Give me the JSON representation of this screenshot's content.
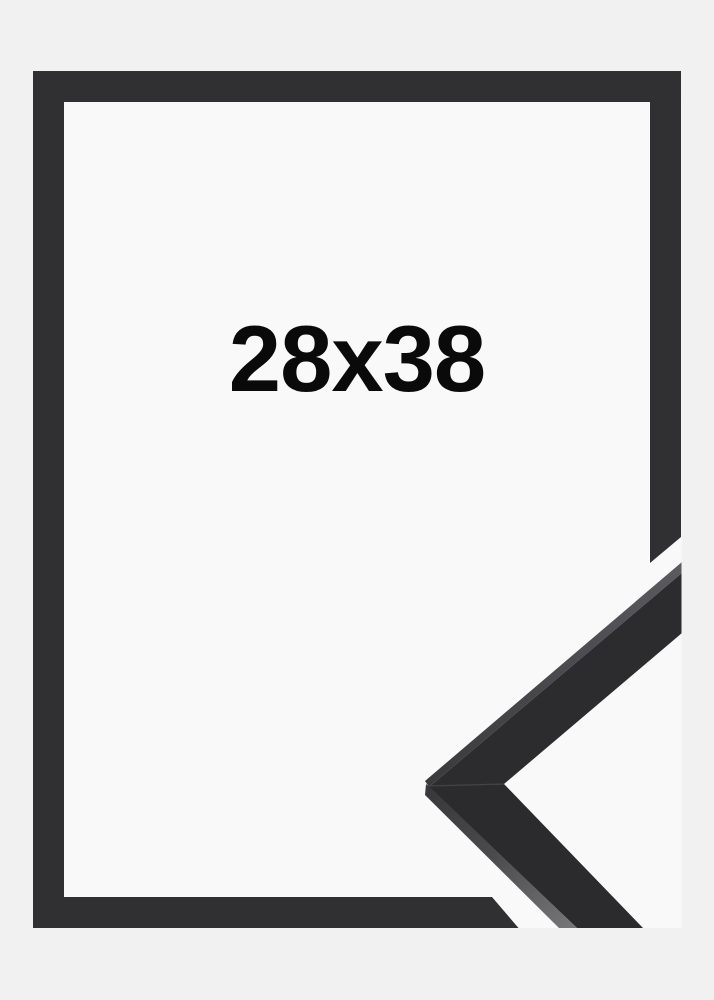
{
  "page": {
    "background_color": "#f1f1f2"
  },
  "product_image": {
    "size_label": "28x38",
    "text_color": "#0a0a0a",
    "backdrop_color": "#f9f9fa",
    "frame_graphic": {
      "border_color": "#303032"
    },
    "corner_sample_photo": {
      "face_color": "#2c2c2e",
      "face_color_lower": "#2b2b2d",
      "miter_seam_color": "#48484a",
      "top_edge_color_near_tip": "#3a3a3c",
      "top_edge_color_far": "#5a5a5f",
      "side_edge_color_top": "#39393b",
      "side_edge_color_mid": "#4a4a4d",
      "side_edge_color_bottom": "#757578"
    }
  }
}
